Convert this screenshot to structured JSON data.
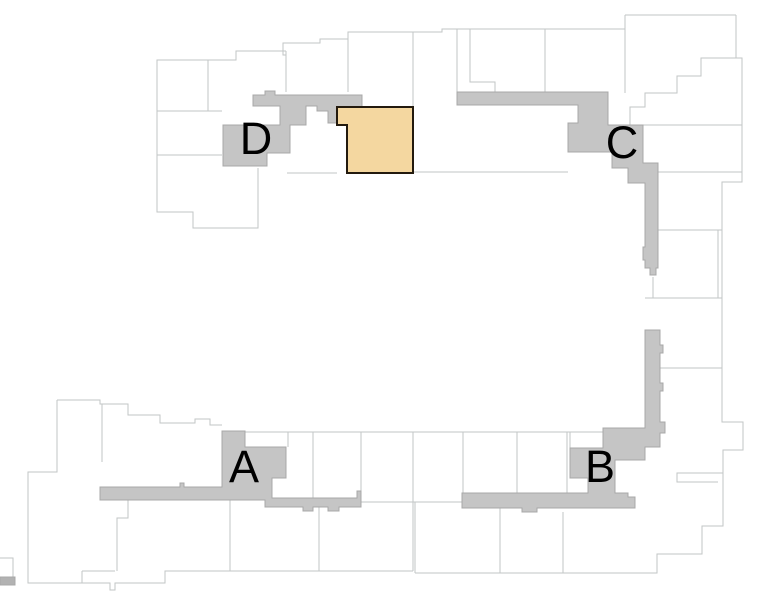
{
  "map": {
    "title": "site-plan",
    "width": 759,
    "height": 591,
    "colors": {
      "background": "#ffffff",
      "outline": "#c2c5c5",
      "corridor_fill": "#c5c5c5",
      "corridor_stroke": "#a8a8a8",
      "highlight_fill": "#f4d7a0",
      "highlight_stroke": "#231a0e",
      "label": "#000000",
      "edge_bar_fill": "#b2b2b2"
    },
    "buildings": [
      {
        "id": "A",
        "label": "A",
        "label_x": 244,
        "label_y": 482,
        "path": "M222,431 L245,431 L245,447 L286,447 L286,478 L272,478 L272,498 L357,498 L357,491 L361,491 L361,507 L339,507 L339,511 L328,511 L328,507 L313,507 L313,511 L303,511 L303,507 L265,507 L265,500 L100,500 L100,487 L180,487 L180,483 L184,483 L184,487 L222,487 Z"
      },
      {
        "id": "B",
        "label": "B",
        "label_x": 600,
        "label_y": 482,
        "path": "M645,330 L660,330 L660,345 L663,345 L663,353 L660,353 L660,383 L663,383 L663,391 L660,391 L660,422 L665,422 L665,433 L660,433 L660,447 L645,447 L645,460 L615,460 L615,493 L628,493 L628,497 L635,497 L635,508 L537,508 L537,512 L522,512 L522,508 L462,508 L462,493 L588,493 L588,478 L570,478 L570,448 L603,448 L603,428 L645,428 Z"
      },
      {
        "id": "C",
        "label": "C",
        "label_x": 622,
        "label_y": 158,
        "path": "M457,92 L608,92 L608,125 L643,125 L643,163 L658,163 L658,268 L656,268 L656,275 L650,275 L650,268 L645,268 L645,260 L643,260 L643,247 L645,247 L645,183 L628,183 L628,168 L612,168 L612,152 L568,152 L568,123 L578,123 L578,105 L457,105 Z"
      },
      {
        "id": "D",
        "label": "D",
        "label_x": 256,
        "label_y": 154,
        "path": "M253,95 L265,95 L265,91 L275,91 L275,95 L362,95 L362,107 L337,107 L337,123 L328,123 L328,111 L317,111 L317,106 L306,106 L306,125 L290,125 L290,153 L267,153 L267,166 L223,166 L223,125 L280,125 L280,106 L253,106 Z"
      }
    ],
    "label_font_size": 45,
    "selected_unit": {
      "path": "M337,107 L413,107 L413,173 L347,173 L347,125 L337,125 Z"
    },
    "edge_bar_path": "M0,577 L15,577 L15,585 L0,585 Z",
    "outline_paths": [
      "M286,51 L236,51 L236,60 L157,60 L157,212 L193,212 L193,228 L258,228 L258,168",
      "M208,60 L208,111",
      "M157,111 L222,111",
      "M157,155 L222,155",
      "M286,51 L286,92",
      "M286,92 L286,55 L283,55 L283,43 L320,43 L320,39 L348,39 L348,32 L413,32 L413,107",
      "M348,39 L348,92",
      "M413,32 L442,32 L442,29 L625,29",
      "M457,29 L457,92",
      "M470,29 L470,82 L495,82 L495,92",
      "M545,29 L545,92",
      "M625,15 L736,15",
      "M625,15 L625,93",
      "M736,15 L736,58 L742,58 L742,182 L722,182 L722,422 L743,422 L743,450 L723,450 L723,473",
      "M608,125 L630,125 L630,107 L645,107 L645,93 L677,93 L677,76 L701,76 L701,58 L736,58",
      "M643,125 L742,125",
      "M658,172 L742,172",
      "M658,230 L722,230",
      "M718,230 L718,298",
      "M645,298 L722,298",
      "M653,277 L653,298",
      "M660,368 L722,368",
      "M287,173 L337,173",
      "M413,172 L568,172",
      "M245,432 L603,432",
      "M288,432 L288,447",
      "M313,432 L313,498",
      "M361,432 L361,491",
      "M413,432 L413,502",
      "M463,432 L463,493",
      "M517,432 L517,493",
      "M567,432 L567,493",
      "M570,432 L570,448",
      "M361,502 L462,502",
      "M57,400 L100,400 L100,404 L128,404 L128,415 L160,415 L160,423 L195,423 L195,419 L210,419 L210,425 L222,425",
      "M57,400 L57,472 L28,472 L28,583 L110,583 L110,590 L115,590 L115,583 L165,583 L165,571 L230,571 L230,500",
      "M102,404 L102,462",
      "M82,571 L115,571",
      "M82,571 L82,583",
      "M128,500 L128,518 L117,518 L117,571",
      "M319,507 L319,571",
      "M230,571 L413,571",
      "M413,502 L413,571",
      "M415,502 L415,573",
      "M415,573 L657,573 L657,554 L702,554 L702,526 L723,526 L723,473",
      "M500,508 L500,573",
      "M563,512 L563,573",
      "M723,473 L677,473 L677,482 L718,482",
      "M0,558 L13,558 L13,577"
    ]
  }
}
